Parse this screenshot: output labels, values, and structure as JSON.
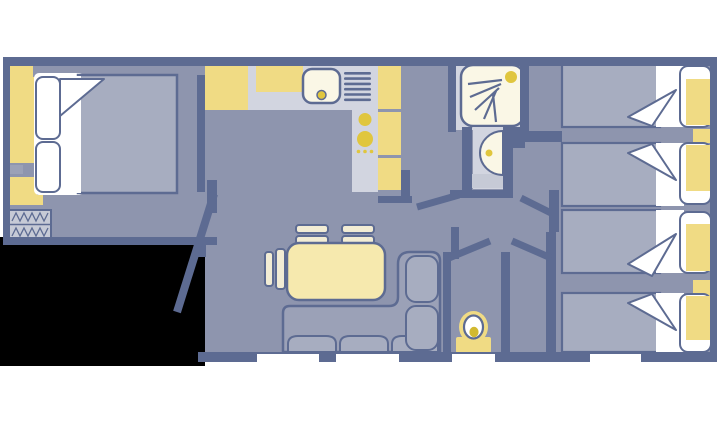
{
  "plan": {
    "type": "caravan-floorplan",
    "rooms": [
      {
        "name": "master-bedroom",
        "furniture": [
          "double-bed",
          "pillow",
          "pillow",
          "wardrobe",
          "wardrobe",
          "bedside-unit",
          "entrance-steps"
        ]
      },
      {
        "name": "kitchen",
        "furniture": [
          "worktop",
          "sink",
          "drainer",
          "hob",
          "wall-cabinet",
          "tall-cabinets"
        ]
      },
      {
        "name": "shower-room",
        "furniture": [
          "shower-tray",
          "shower-head",
          "washbasin",
          "pedestal"
        ]
      },
      {
        "name": "lounge-diner",
        "furniture": [
          "dining-table",
          "chair",
          "chair",
          "side-chair",
          "corner-sofa"
        ]
      },
      {
        "name": "wc",
        "furniture": [
          "toilet",
          "cistern"
        ]
      },
      {
        "name": "twin-bedroom-front",
        "furniture": [
          "single-bed",
          "single-bed",
          "head-shelf"
        ]
      },
      {
        "name": "twin-bedroom-rear",
        "furniture": [
          "single-bed",
          "single-bed",
          "head-shelf"
        ]
      }
    ],
    "counts": {
      "double_beds": 1,
      "single_beds": 4,
      "bottom_wall_windows": 4,
      "open_door_leaves": 5
    }
  },
  "colors": {
    "background": "#ffffff",
    "outside": "#000000",
    "wall": "#5d6b92",
    "floor": "#8e95ae",
    "furniture_light": "#d2d5e0",
    "step_grey": "#c6cad6",
    "bedding": "#a7adc0",
    "sofa": "#9ba1b7",
    "cushion": "#a7adc0",
    "accent_yellow": "#f0db84",
    "accent_yellow_deep": "#e0c63e",
    "fixture_cream": "#faf7e6",
    "table_cream": "#f6e9ae",
    "chair_cream": "#f2ecd4",
    "toilet_seat": "#d2b930",
    "window_white": "#ffffff"
  }
}
